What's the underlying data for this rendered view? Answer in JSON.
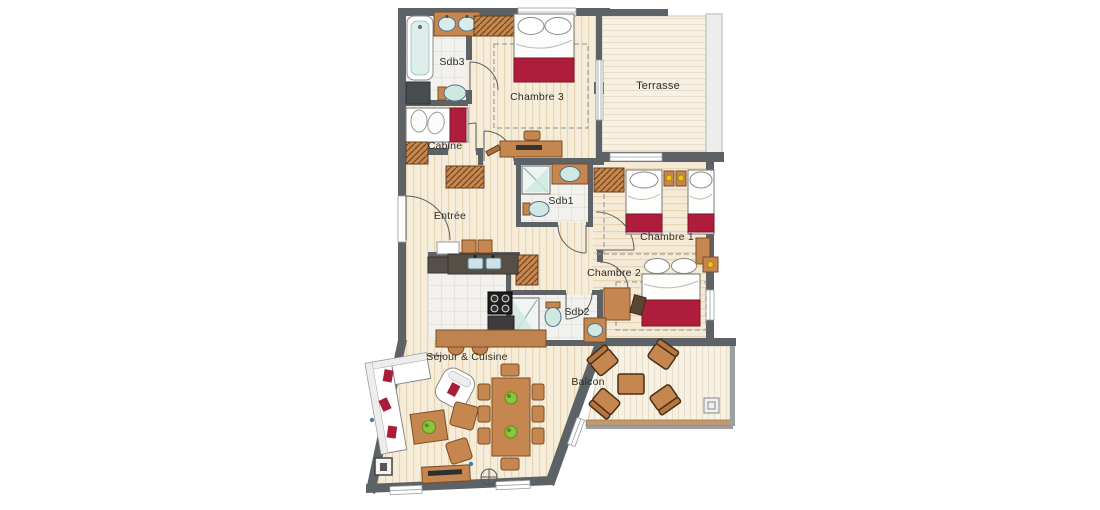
{
  "floorplan": {
    "labels": {
      "sdb3": "Sdb3",
      "chambre3": "Chambre 3",
      "terrasse": "Terrasse",
      "cabine": "Cabine",
      "entree": "Entrée",
      "sdb1": "Sdb1",
      "chambre1": "Chambre 1",
      "chambre2": "Chambre 2",
      "sdb2": "Sdb2",
      "sejour": "Séjour & Cuisine",
      "balcon": "Balcon"
    },
    "colors": {
      "wall": "#5d6266",
      "wood_floor": "#f6ecda",
      "wood_stripe": "#e3cda6",
      "tile_floor": "#f2f1ed",
      "deck_floor": "#f7f1e4",
      "furniture_brown": "#c5874f",
      "counter_dark": "#564f47",
      "accent_red": "#ae1e3c",
      "fixture_blue": "#cfe8e2",
      "highlight_yellow": "#f2c316",
      "plant_green": "#8cc63e",
      "label_text": "#2d2d2d"
    }
  }
}
